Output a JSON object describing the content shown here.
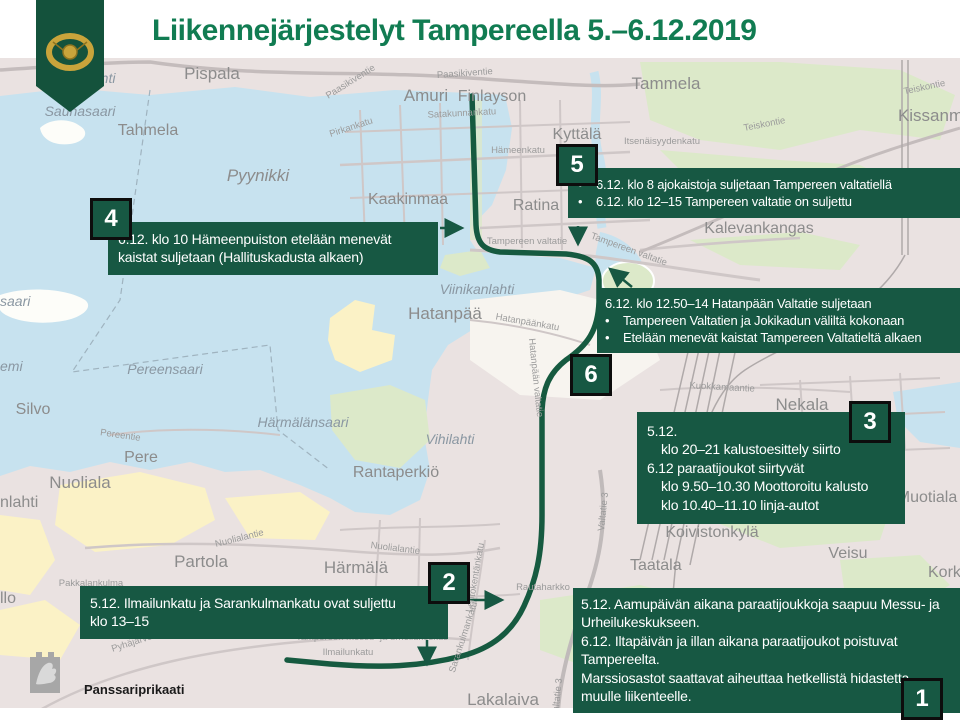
{
  "title": "Liikennejärjestelyt Tampereella 5.–6.12.2019",
  "glyphs": {
    "bullet": "•"
  },
  "brand": {
    "unit": "Panssariprikaati"
  },
  "colors": {
    "accent_green": "#175843",
    "title_green": "#117C52",
    "route_green": "#165A40",
    "badge_border": "#0d0d0d",
    "water": "#C7E2EF",
    "land": "#EAE2E1",
    "yellow_area": "#FBF2C6",
    "green_area": "#DCE9C9",
    "label_gray": "#8C8C8C"
  },
  "callouts": {
    "c1": {
      "number": "1",
      "paragraphs": [
        "5.12. Aamupäivän aikana paraatijoukkoja saapuu Messu- ja Urheilukeskukseen.",
        "6.12. Iltapäivän ja illan aikana paraatijoukot poistuvat Tampereelta.",
        "Marssiosastot saattavat aiheuttaa hetkellistä hidastetta muulle liikenteelle."
      ]
    },
    "c2": {
      "number": "2",
      "lines": [
        "5.12. Ilmailunkatu ja Sarankulmankatu ovat suljettu",
        "klo 13–15"
      ]
    },
    "c3": {
      "number": "3",
      "lines": [
        "5.12.",
        "klo 20–21 kalustoesittely siirto",
        "6.12 paraatijoukot siirtyvät",
        "klo 9.50–10.30 Moottoroitu kalusto",
        "klo 10.40–11.10 linja-autot"
      ]
    },
    "c4": {
      "number": "4",
      "text": "6.12. klo 10 Hämeenpuiston etelään menevät kaistat suljetaan (Hallituskadusta alkaen)"
    },
    "c5": {
      "number": "5",
      "items": [
        "6.12. klo 8 ajokaistoja suljetaan Tampereen valtatiellä",
        "6.12. klo 12–15 Tampereen valtatie on suljettu"
      ]
    },
    "c6": {
      "number": "6",
      "heading": "6.12. klo 12.50–14 Hatanpään Valtatie suljetaan",
      "items": [
        "Tampereen Valtatien ja Jokikadun väliltä kokonaan",
        "Etelään menevät kaistat Tampereen Valtatieltä alkaen"
      ]
    }
  },
  "map": {
    "districts": {
      "pispala": "Pispala",
      "amuri": "Amuri",
      "finlayson": "Finlayson",
      "tammela": "Tammela",
      "kissanmaa": "Kissanmaa",
      "tahmela": "Tahmela",
      "pyynikki": "Pyynikki",
      "kaakinmaa": "Kaakinmaa",
      "kyttala": "Kyttälä",
      "ratina": "Ratina",
      "kalevankangas": "Kalevankangas",
      "hatanpaa": "Hatanpää",
      "nekala": "Nekala",
      "muotiala": "Muotiala",
      "veisu": "Veisu",
      "korkinmaki": "Korkinmäki",
      "taatala": "Taatala",
      "koivistonkyla": "Koivistonkylä",
      "rautaharkko": "Rautaharkko",
      "lakalaiva": "Lakalaiva",
      "harmala": "Härmälä",
      "partola": "Partola",
      "pakkalankulma": "Pakkalankulma",
      "silvo": "Silvo",
      "pere": "Pere",
      "nuoliala": "Nuoliala",
      "rantaperkio": "Rantaperkiö"
    },
    "water_labels": {
      "saunasaari": "Saunasaari",
      "viinikanlahti": "Viinikanlahti",
      "pereensaari": "Pereensaari",
      "harmalansaari": "Härmälänsaari",
      "vihilahti": "Vihilahti"
    },
    "edge_labels": {
      "saari": "saari",
      "emi": "emi",
      "llo": "llo",
      "nlahti": "nlahti",
      "nlahti_top": "nlahti"
    },
    "roads": {
      "paasikiventie": "Paasikiventie",
      "pirkankatu": "Pirkankatu",
      "satakunnankatu": "Satakunnankatu",
      "hameenkatu": "Hämeenkatu",
      "itsenaisyydenkatu": "Itsenäisyydenkatu",
      "teiskontie": "Teiskontie",
      "tampereen_valtatie": "Tampereen valtatie",
      "hatanpaankatu": "Hatanpäänkatu",
      "hatanpaan_valtatie": "Hatanpään valtatie",
      "kuokkamaantie": "Kuokkamaantie",
      "nuolialantie": "Nuolialantie",
      "pereentie": "Pereentie",
      "pyhajarventie": "Pyhäjärventie",
      "lentokentankatu": "Lentokentänkatu",
      "sarankulmankatu": "Sarankulmankatu",
      "ilmailunkatu": "Ilmailunkatu",
      "valtatie3": "Valtatie 3",
      "messukeskus": "Tampereen messu- ja urheilukeskus"
    }
  }
}
